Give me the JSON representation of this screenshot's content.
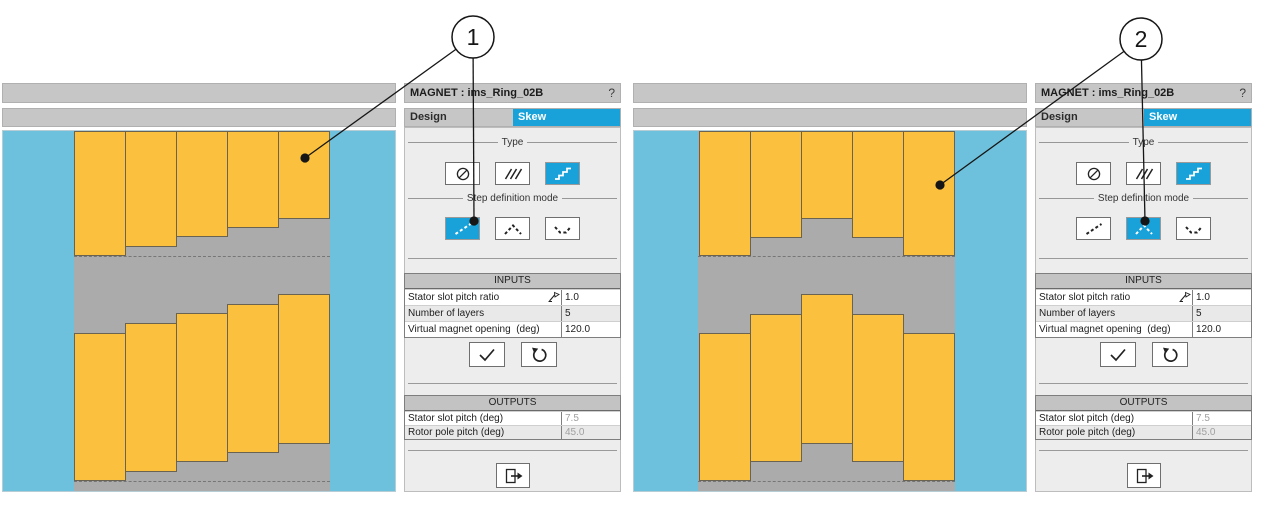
{
  "canvas": {
    "width": 1264,
    "height": 518
  },
  "colors": {
    "accent": "#18a2d9",
    "view_blue": "#6ec1dc",
    "magnet_orange": "#fbc13e",
    "rotor_gray": "#ababab",
    "bar_gray": "#c6c6c6",
    "panel_bg": "#ededed",
    "table_header": "#c3c3c3",
    "disabled_text": "#a0a0a0"
  },
  "callouts": [
    {
      "label": "1",
      "cx": 473,
      "cy": 37,
      "r": 21,
      "targets": [
        [
          305,
          158
        ],
        [
          474,
          221
        ]
      ]
    },
    {
      "label": "2",
      "cx": 1141,
      "cy": 39,
      "r": 21,
      "targets": [
        [
          940,
          185
        ],
        [
          1145,
          221
        ]
      ]
    }
  ],
  "windows": [
    {
      "x": 2,
      "title": "MAGNET : ims_Ring_02B",
      "help_label": "?",
      "tabs": [
        {
          "label": "Design",
          "active": false
        },
        {
          "label": "Skew",
          "active": true
        }
      ],
      "type_section_label": "Type",
      "step_section_label": "Step definition mode",
      "type_buttons": [
        {
          "icon": "no-skew",
          "active": false
        },
        {
          "icon": "continuous-skew",
          "active": false
        },
        {
          "icon": "step-skew",
          "active": true
        }
      ],
      "step_buttons": [
        {
          "icon": "linear-steps",
          "active": true
        },
        {
          "icon": "peak-steps",
          "active": false
        },
        {
          "icon": "valley-steps",
          "active": false
        }
      ],
      "inputs": {
        "header": "INPUTS",
        "rows": [
          {
            "label": "Stator slot pitch ratio",
            "value": "1.0",
            "has_formula_icon": true
          },
          {
            "label": "Number of layers",
            "value": "5"
          },
          {
            "label": "Virtual magnet opening  (deg)",
            "value": "120.0"
          }
        ]
      },
      "outputs": {
        "header": "OUTPUTS",
        "rows": [
          {
            "label": "Stator slot pitch (deg)",
            "value": "7.5"
          },
          {
            "label": "Rotor pole pitch (deg)",
            "value": "45.0"
          }
        ]
      },
      "diagram": {
        "strip_x": 71,
        "strip_w": 256,
        "block_w": 52,
        "dash_y": [
          125,
          350
        ],
        "blocks": [
          {
            "x": 71,
            "y": 0,
            "h": 125
          },
          {
            "x": 122,
            "y": 0,
            "h": 116
          },
          {
            "x": 173,
            "y": 0,
            "h": 106
          },
          {
            "x": 224,
            "y": 0,
            "h": 97
          },
          {
            "x": 275,
            "y": 0,
            "h": 88
          },
          {
            "x": 71,
            "y": 202,
            "h": 148
          },
          {
            "x": 122,
            "y": 192,
            "h": 149
          },
          {
            "x": 173,
            "y": 182,
            "h": 149
          },
          {
            "x": 224,
            "y": 173,
            "h": 149
          },
          {
            "x": 275,
            "y": 163,
            "h": 150
          }
        ]
      }
    },
    {
      "x": 633,
      "title": "MAGNET : ims_Ring_02B",
      "help_label": "?",
      "tabs": [
        {
          "label": "Design",
          "active": false
        },
        {
          "label": "Skew",
          "active": true
        }
      ],
      "type_section_label": "Type",
      "step_section_label": "Step definition mode",
      "type_buttons": [
        {
          "icon": "no-skew",
          "active": false
        },
        {
          "icon": "continuous-skew",
          "active": false
        },
        {
          "icon": "step-skew",
          "active": true
        }
      ],
      "step_buttons": [
        {
          "icon": "linear-steps",
          "active": false
        },
        {
          "icon": "peak-steps",
          "active": true
        },
        {
          "icon": "valley-steps",
          "active": false
        }
      ],
      "inputs": {
        "header": "INPUTS",
        "rows": [
          {
            "label": "Stator slot pitch ratio",
            "value": "1.0",
            "has_formula_icon": true
          },
          {
            "label": "Number of layers",
            "value": "5"
          },
          {
            "label": "Virtual magnet opening  (deg)",
            "value": "120.0"
          }
        ]
      },
      "outputs": {
        "header": "OUTPUTS",
        "rows": [
          {
            "label": "Stator slot pitch (deg)",
            "value": "7.5"
          },
          {
            "label": "Rotor pole pitch (deg)",
            "value": "45.0"
          }
        ]
      },
      "diagram": {
        "strip_x": 64,
        "strip_w": 257,
        "block_w": 52,
        "dash_y": [
          125,
          350
        ],
        "blocks": [
          {
            "x": 65,
            "y": 0,
            "h": 125
          },
          {
            "x": 116,
            "y": 0,
            "h": 107
          },
          {
            "x": 167,
            "y": 0,
            "h": 88
          },
          {
            "x": 218,
            "y": 0,
            "h": 107
          },
          {
            "x": 269,
            "y": 0,
            "h": 125
          },
          {
            "x": 65,
            "y": 202,
            "h": 148
          },
          {
            "x": 116,
            "y": 183,
            "h": 148
          },
          {
            "x": 167,
            "y": 163,
            "h": 150
          },
          {
            "x": 218,
            "y": 183,
            "h": 148
          },
          {
            "x": 269,
            "y": 202,
            "h": 148
          }
        ]
      }
    }
  ]
}
